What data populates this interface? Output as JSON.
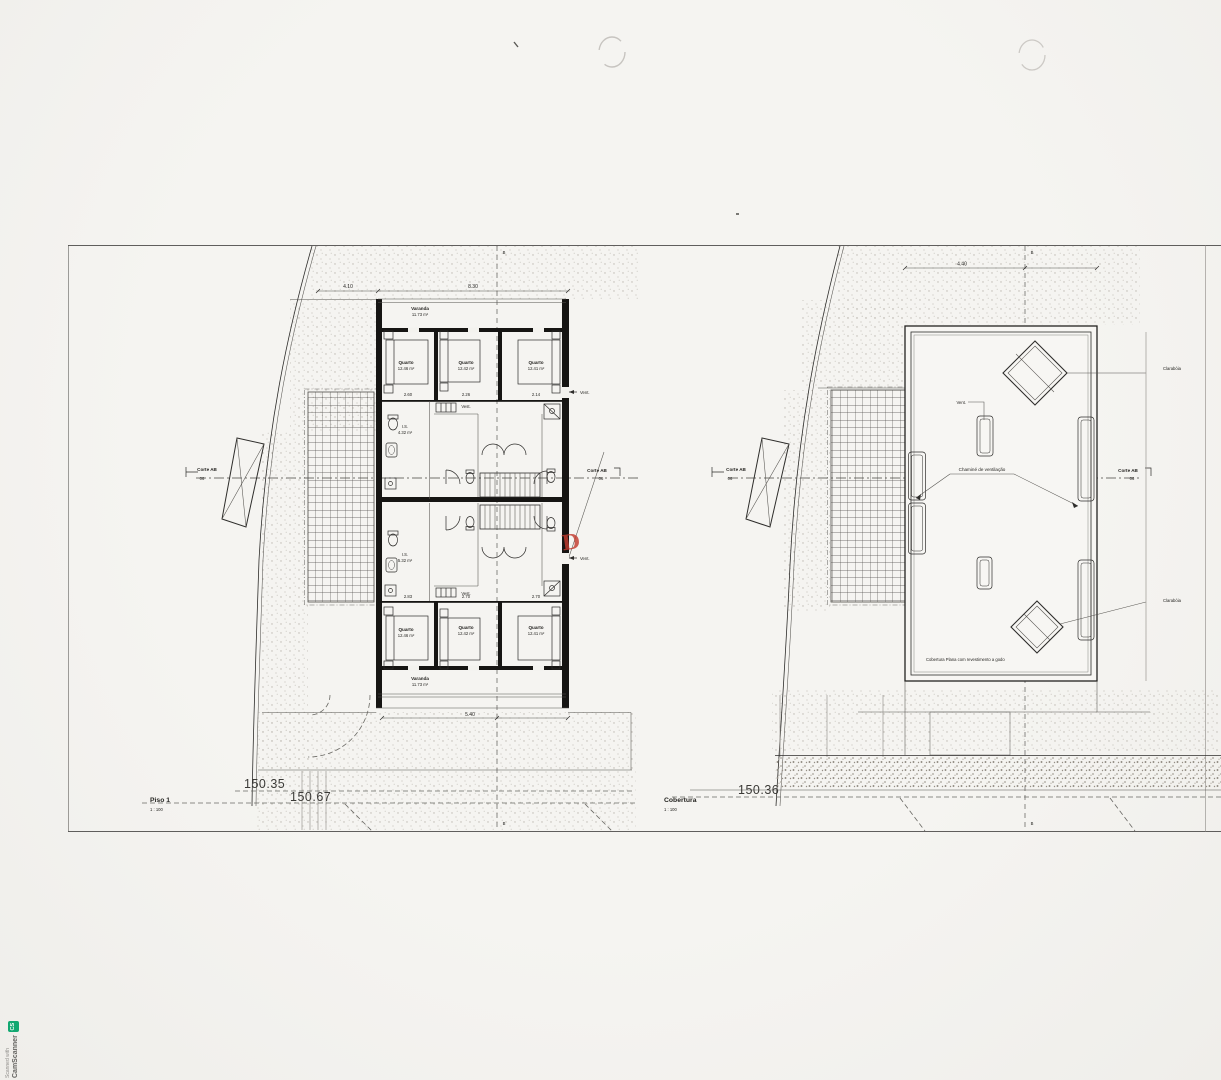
{
  "sheet": {
    "paper_color": "#f3f2ee",
    "ink_color": "#2e2d2b",
    "stamp_color": "#c23b2e",
    "watermark": {
      "prefix": "Scanned with",
      "brand": "CamScanner",
      "icon_text": "CS",
      "icon_color": "#12a871"
    }
  },
  "left_plan": {
    "title": "Piso 1",
    "scale": "1 : 100",
    "elevation_upper": "150.35",
    "elevation_lower": "150.67",
    "section_left": {
      "label": "Corte AB",
      "sheet": "06"
    },
    "section_right": {
      "label": "Corte AB",
      "sheet": "06"
    },
    "axis_marker": "B",
    "stamp_letter": "D",
    "rooms": {
      "varanda_top": {
        "name": "Varanda",
        "area": "11.73 m²"
      },
      "quarto_t1": {
        "name": "Quarto",
        "area": "12.46 m²"
      },
      "quarto_t2": {
        "name": "Quarto",
        "area": "12.42 m²"
      },
      "quarto_t3": {
        "name": "Quarto",
        "area": "12.41 m²"
      },
      "is_top": {
        "name": "I.S.",
        "area": "4.32 m²"
      },
      "vest_top": "Vest.",
      "vent_top": "Vent.",
      "is_bottom": {
        "name": "I.S.",
        "area": "5.32 m²"
      },
      "vest_bottom": "Vest.",
      "vent_bottom": "Vent.",
      "quarto_b1": {
        "name": "Quarto",
        "area": "12.46 m²"
      },
      "quarto_b2": {
        "name": "Quarto",
        "area": "12.42 m²"
      },
      "quarto_b3": {
        "name": "Quarto",
        "area": "12.41 m²"
      },
      "varanda_bottom": {
        "name": "Varanda",
        "area": "11.73 m²"
      }
    },
    "dims": {
      "top_terrace": "4.10",
      "top_building": "8.30",
      "t1": "2.60",
      "t2": "2.26",
      "t3": "2.14",
      "b1": "2.83",
      "b2": "2.70",
      "b3": "2.70",
      "bottom": "5.40"
    }
  },
  "right_plan": {
    "title": "Cobertura",
    "scale": "1 : 100",
    "elevation": "150.36",
    "section_left": {
      "label": "Corte AB",
      "sheet": "06"
    },
    "section_right": {
      "label": "Corte AB",
      "sheet": "06"
    },
    "axis_marker": "B",
    "dims": {
      "top": "4.40"
    },
    "annotations": {
      "vent": "Vent.",
      "chimney": "Chaminé de ventilação",
      "skylight_1": "Clarabóia",
      "skylight_2": "Clarabóia",
      "flat_roof": "Cobertura Plana com revestimento a godo"
    }
  }
}
